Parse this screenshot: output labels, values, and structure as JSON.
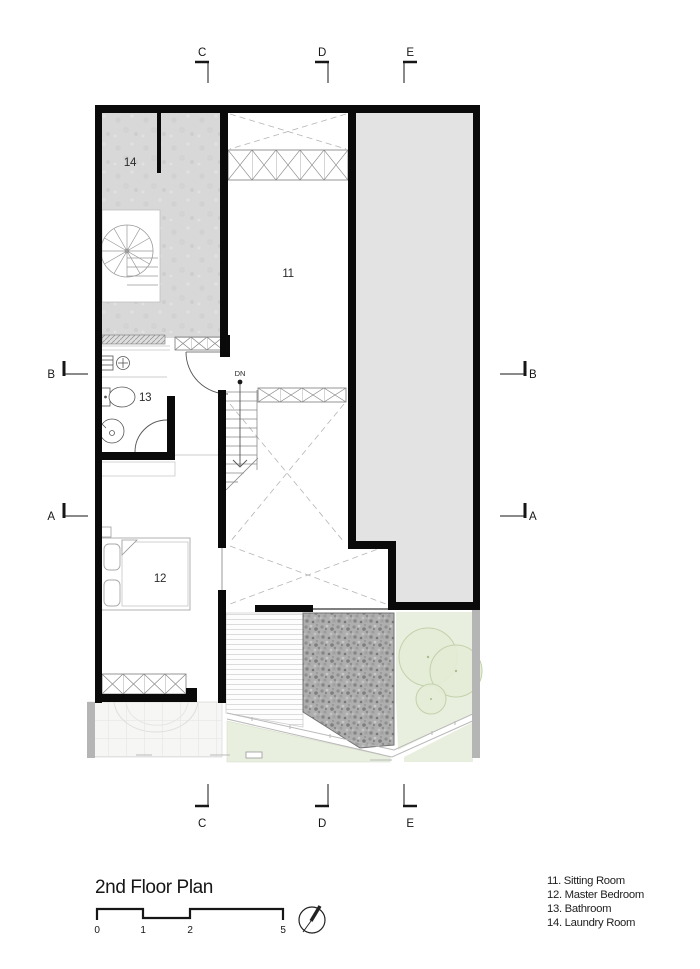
{
  "title": "2nd Floor Plan",
  "scale_bar": {
    "labels": [
      "0",
      "1",
      "2",
      "5"
    ]
  },
  "markers": {
    "top": [
      "C",
      "D",
      "E"
    ],
    "bottom": [
      "C",
      "D",
      "E"
    ],
    "left": [
      "B",
      "A"
    ],
    "right": [
      "B",
      "A"
    ]
  },
  "rooms": {
    "sitting": {
      "number": "11",
      "name": "Sitting Room"
    },
    "master_bedroom": {
      "number": "12",
      "name": "Master Bedroom"
    },
    "bathroom": {
      "number": "13",
      "name": "Bathroom"
    },
    "laundry": {
      "number": "14",
      "name": "Laundry Room"
    }
  },
  "stairs": {
    "down_label": "DN"
  },
  "legend": {
    "items": [
      "11. Sitting Room",
      "12. Master Bedroom",
      "13. Bathroom",
      "14. Laundry Room"
    ]
  },
  "icons": {
    "north_arrow": "compass-needle"
  },
  "colors": {
    "wall": "#0a0a0a",
    "concrete_floor": "#d8d8d8",
    "upper_mass": "#e3e3e3",
    "lawn": "#e9efde",
    "tree": "#e4ecd6",
    "gravel": "#aeaeae",
    "side_strip": "#b5b5b5"
  }
}
